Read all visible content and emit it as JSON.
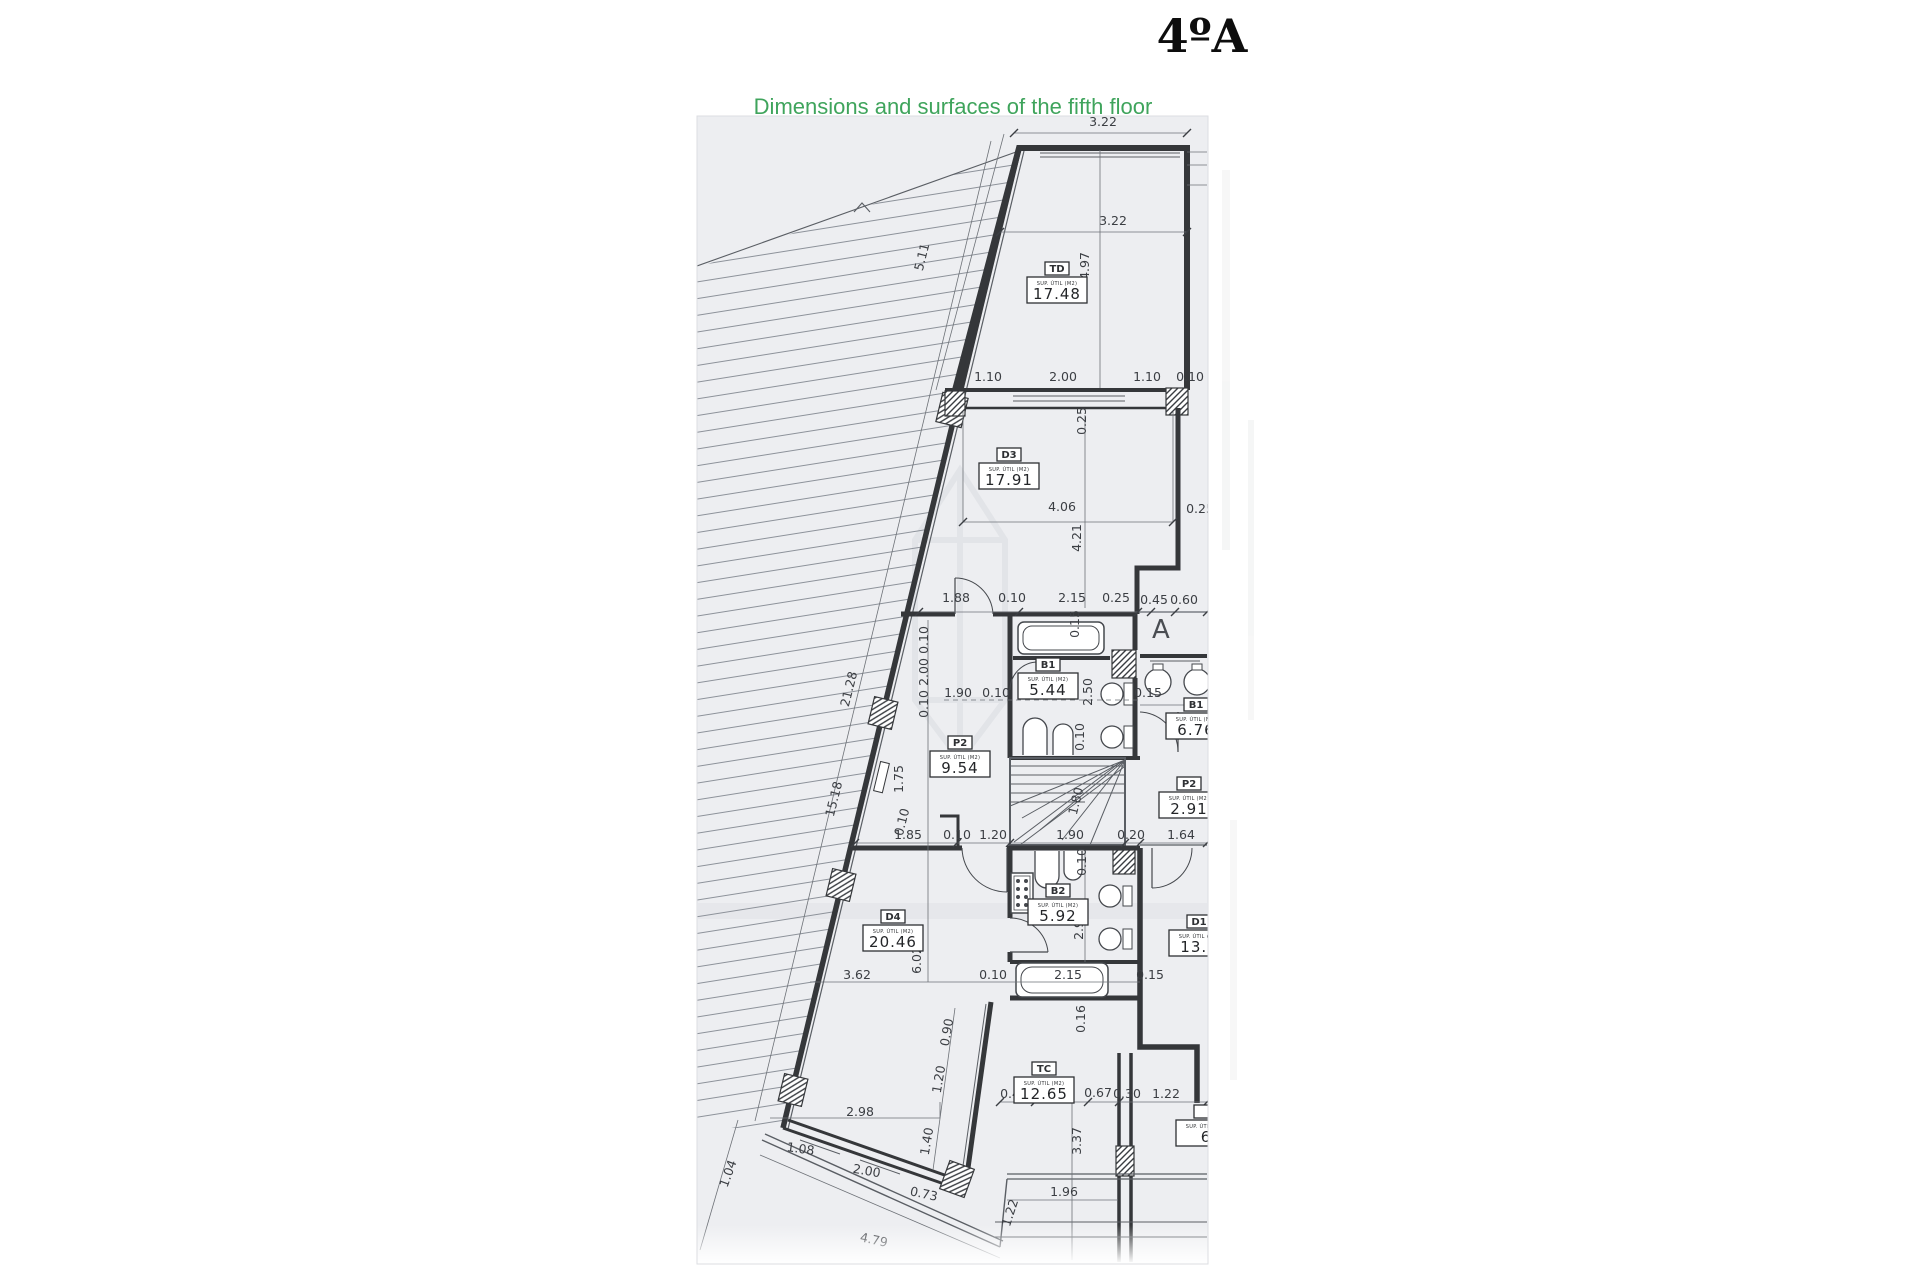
{
  "title": "4ºA",
  "subtitle": "Dimensions and surfaces of the fifth floor",
  "colors": {
    "subtitle_green": "#3fa45c",
    "page_background": "#edeef1",
    "wall_line": "#35373a",
    "title_black": "#0d0d0d"
  },
  "plan": {
    "zone_letter": "A",
    "label_header": "SUP. ÚTIL (M2)",
    "rooms": [
      {
        "code": "TD",
        "area": "17.48",
        "x": 1057,
        "y": 288
      },
      {
        "code": "D3",
        "area": "17.91",
        "x": 1009,
        "y": 474
      },
      {
        "code": "B1",
        "area": "5.44",
        "x": 1048,
        "y": 684
      },
      {
        "code": "B1",
        "area": "6.76",
        "x": 1196,
        "y": 724
      },
      {
        "code": "P2",
        "area": "9.54",
        "x": 960,
        "y": 762
      },
      {
        "code": "P2",
        "area": "2.91",
        "x": 1189,
        "y": 803
      },
      {
        "code": "D4",
        "area": "20.46",
        "x": 893,
        "y": 936
      },
      {
        "code": "B2",
        "area": "5.92",
        "x": 1058,
        "y": 910
      },
      {
        "code": "D1",
        "area": "13.9",
        "x": 1199,
        "y": 941
      },
      {
        "code": "TC",
        "area": "12.65",
        "x": 1044,
        "y": 1088
      },
      {
        "code": "",
        "area": "6",
        "x": 1206,
        "y": 1131
      }
    ],
    "dims": [
      {
        "v": "3.22",
        "x": 1103,
        "y": 126
      },
      {
        "v": "3.22",
        "x": 1113,
        "y": 225
      },
      {
        "v": "4.97",
        "x": 1089,
        "y": 266,
        "r": -90
      },
      {
        "v": "5.11",
        "x": 926,
        "y": 258,
        "r": -76
      },
      {
        "v": "1.10",
        "x": 988,
        "y": 381
      },
      {
        "v": "2.00",
        "x": 1063,
        "y": 381
      },
      {
        "v": "1.10",
        "x": 1147,
        "y": 381
      },
      {
        "v": "0.10",
        "x": 1190,
        "y": 381
      },
      {
        "v": "0.25",
        "x": 1086,
        "y": 421,
        "r": -90
      },
      {
        "v": "4.06",
        "x": 1062,
        "y": 511
      },
      {
        "v": "0.25",
        "x": 1200,
        "y": 513
      },
      {
        "v": "4.21",
        "x": 1081,
        "y": 538,
        "r": -90
      },
      {
        "v": "1.88",
        "x": 956,
        "y": 602
      },
      {
        "v": "0.10",
        "x": 1012,
        "y": 602
      },
      {
        "v": "2.15",
        "x": 1072,
        "y": 602
      },
      {
        "v": "0.25",
        "x": 1116,
        "y": 602
      },
      {
        "v": "0.45",
        "x": 1154,
        "y": 604
      },
      {
        "v": "0.60",
        "x": 1184,
        "y": 604
      },
      {
        "v": "0.15",
        "x": 1079,
        "y": 624,
        "r": -90
      },
      {
        "v": "21.28",
        "x": 853,
        "y": 690,
        "r": -76
      },
      {
        "v": "15.18",
        "x": 838,
        "y": 800,
        "r": -76
      },
      {
        "v": "0.10",
        "x": 928,
        "y": 640,
        "r": -90
      },
      {
        "v": "2.00",
        "x": 928,
        "y": 672,
        "r": -90
      },
      {
        "v": "0.10",
        "x": 928,
        "y": 704,
        "r": -90
      },
      {
        "v": "2.50",
        "x": 1092,
        "y": 692,
        "r": -90
      },
      {
        "v": "1.90",
        "x": 958,
        "y": 697
      },
      {
        "v": "0.10",
        "x": 996,
        "y": 697
      },
      {
        "v": "2.15",
        "x": 1058,
        "y": 697
      },
      {
        "v": "0.15",
        "x": 1148,
        "y": 697
      },
      {
        "v": "0.10",
        "x": 1084,
        "y": 737,
        "r": -90
      },
      {
        "v": "1.75",
        "x": 903,
        "y": 779,
        "r": -90
      },
      {
        "v": "0.10",
        "x": 906,
        "y": 823,
        "r": -76
      },
      {
        "v": "1.80",
        "x": 1080,
        "y": 802,
        "r": -76
      },
      {
        "v": "1.85",
        "x": 908,
        "y": 839
      },
      {
        "v": "0.10",
        "x": 957,
        "y": 839
      },
      {
        "v": "1.20",
        "x": 993,
        "y": 839
      },
      {
        "v": "1.90",
        "x": 1070,
        "y": 839
      },
      {
        "v": "0.20",
        "x": 1131,
        "y": 839
      },
      {
        "v": "1.64",
        "x": 1181,
        "y": 839
      },
      {
        "v": "0.10",
        "x": 1086,
        "y": 862,
        "r": -90
      },
      {
        "v": "2.93",
        "x": 1083,
        "y": 926,
        "r": -90
      },
      {
        "v": "6.02",
        "x": 921,
        "y": 960,
        "r": -90
      },
      {
        "v": "3.62",
        "x": 857,
        "y": 979
      },
      {
        "v": "0.10",
        "x": 993,
        "y": 979
      },
      {
        "v": "2.15",
        "x": 1068,
        "y": 979
      },
      {
        "v": "0.15",
        "x": 1150,
        "y": 979
      },
      {
        "v": "0.16",
        "x": 1085,
        "y": 1019,
        "r": -90
      },
      {
        "v": "0.90",
        "x": 951,
        "y": 1033,
        "r": -80
      },
      {
        "v": "1.20",
        "x": 943,
        "y": 1080,
        "r": -80
      },
      {
        "v": "1.40",
        "x": 931,
        "y": 1142,
        "r": -80
      },
      {
        "v": "2.98",
        "x": 860,
        "y": 1116
      },
      {
        "v": "1.08",
        "x": 800,
        "y": 1153,
        "r": 8
      },
      {
        "v": "2.00",
        "x": 866,
        "y": 1175,
        "r": 10
      },
      {
        "v": "0.73",
        "x": 923,
        "y": 1198,
        "r": 12
      },
      {
        "v": "1.04",
        "x": 732,
        "y": 1175,
        "r": -70
      },
      {
        "v": "4.79",
        "x": 873,
        "y": 1244,
        "r": 12
      },
      {
        "v": "0.49",
        "x": 1014,
        "y": 1098
      },
      {
        "v": "1.00",
        "x": 1053,
        "y": 1098
      },
      {
        "v": "0.67",
        "x": 1098,
        "y": 1097
      },
      {
        "v": "0.30",
        "x": 1127,
        "y": 1098
      },
      {
        "v": "1.22",
        "x": 1166,
        "y": 1098
      },
      {
        "v": "3.37",
        "x": 1081,
        "y": 1141,
        "r": -90
      },
      {
        "v": "1.96",
        "x": 1064,
        "y": 1196
      },
      {
        "v": "1.22",
        "x": 1014,
        "y": 1214,
        "r": -72
      }
    ]
  }
}
